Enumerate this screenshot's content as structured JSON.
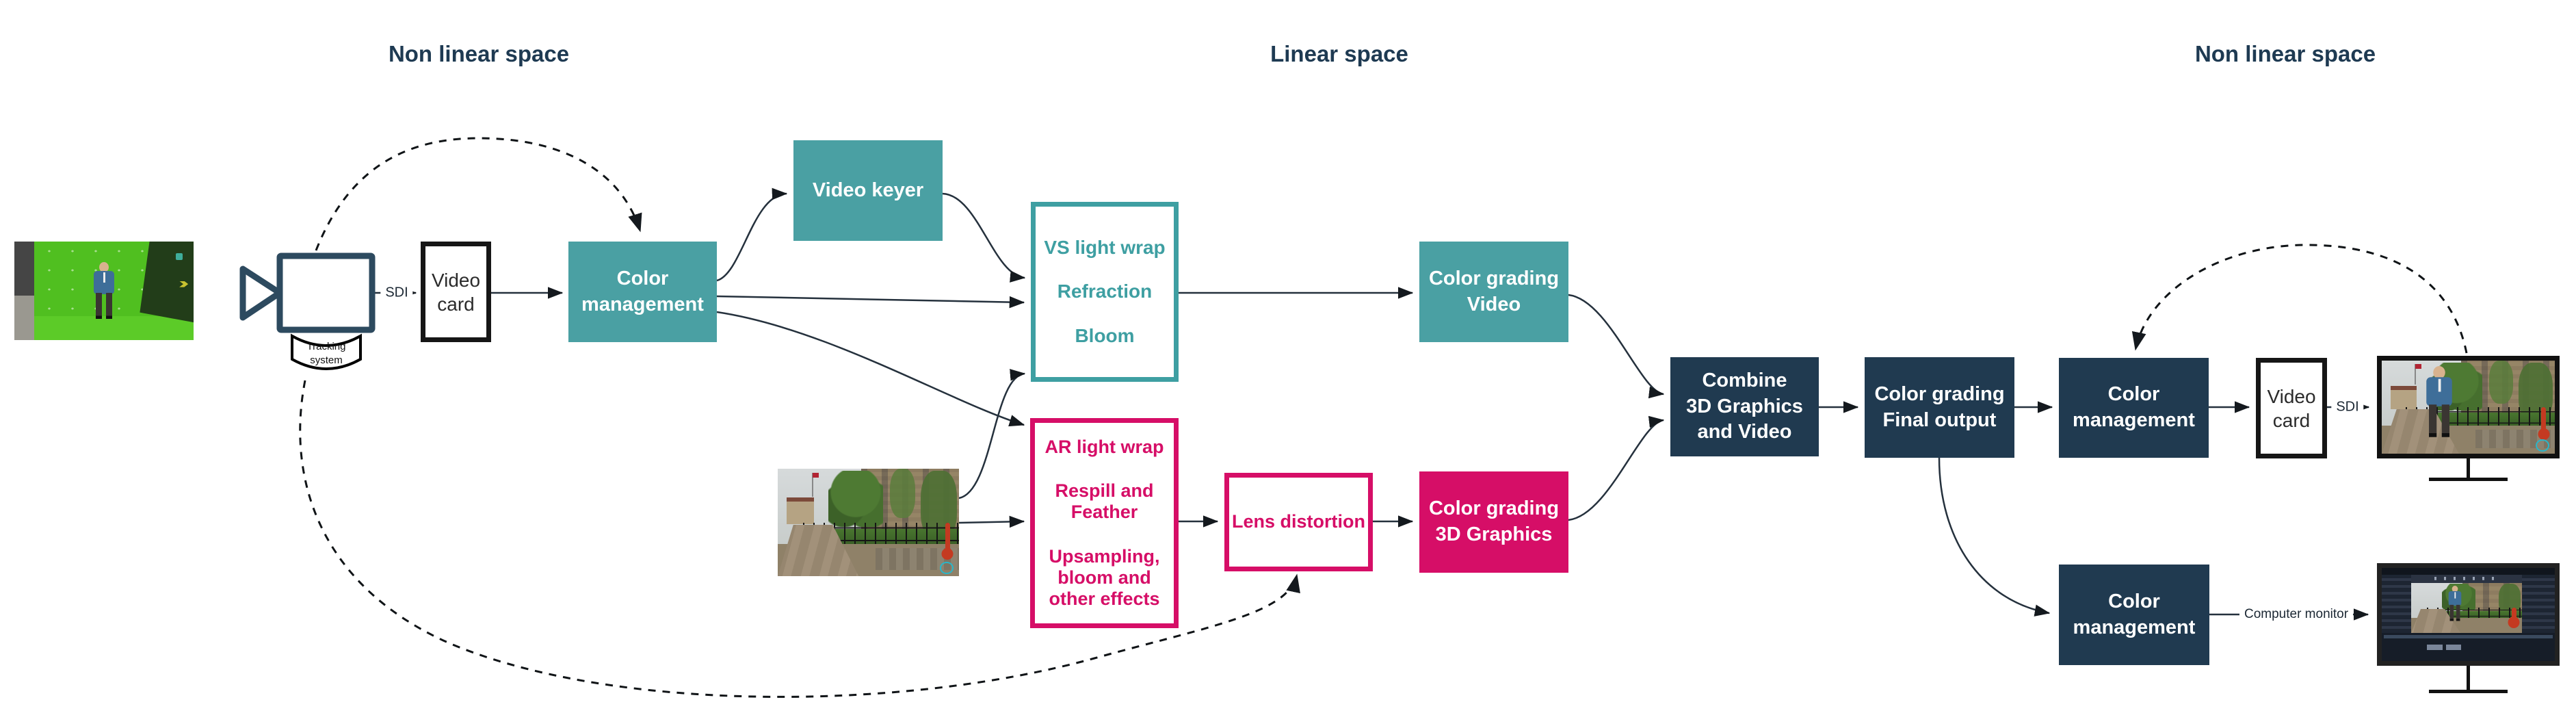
{
  "headers": {
    "left": "Non linear space",
    "center": "Linear space",
    "right": "Non linear space"
  },
  "colors": {
    "teal": "#4AA0A3",
    "magenta": "#D60E67",
    "navy": "#203A50",
    "connector": "#25313D"
  },
  "nodes": {
    "tracking_system": "Tracking\nsystem",
    "sdi_camera": "SDI",
    "video_card_in": "Video\ncard",
    "color_management_in": "Color\nmanagement",
    "video_keyer": "Video keyer",
    "vs_effects": {
      "light_wrap": "VS light wrap",
      "refraction": "Refraction",
      "bloom": "Bloom"
    },
    "ar_effects": {
      "light_wrap": "AR light wrap",
      "respill": "Respill and\nFeather",
      "upsampling": "Upsampling,\nbloom and\nother effects"
    },
    "lens_distortion": "Lens distortion",
    "color_grading_video": "Color grading\nVideo",
    "color_grading_3d": "Color grading\n3D Graphics",
    "combine": "Combine\n3D Graphics\nand Video",
    "color_grading_final": "Color grading\nFinal output",
    "color_management_out": "Color\nmanagement",
    "video_card_out": "Video\ncard",
    "sdi_out": "SDI",
    "color_management_monitor": "Color\nmanagement",
    "computer_monitor": "Computer monitor"
  }
}
